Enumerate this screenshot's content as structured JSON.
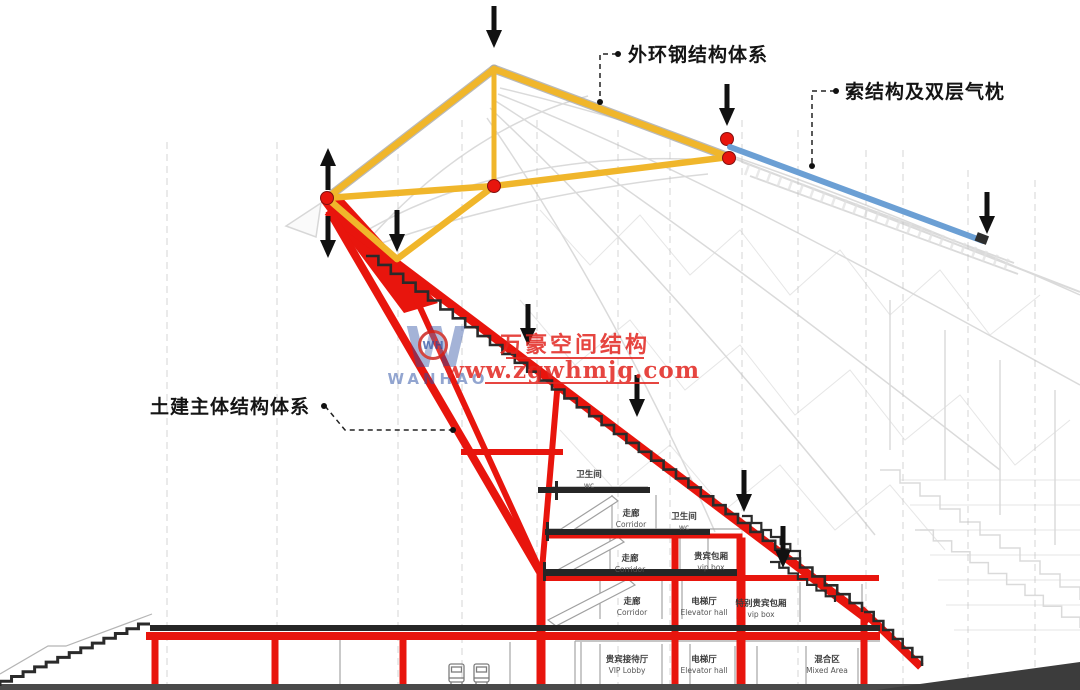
{
  "title": "stadium-structure-section-diagram",
  "annotations": {
    "outer_ring_label": "外环钢结构体系",
    "cable_label": "索结构及双层气枕",
    "civil_label": "土建主体结构体系"
  },
  "watermark": {
    "line1": "万豪空间结构",
    "line2": "www.zgwhmjg.com",
    "logo_letter": "W",
    "logo_monogram": "WH",
    "logo_name": "WANHAO"
  },
  "rooms": [
    {
      "zh": "卫生间",
      "en": "wc",
      "x": 589,
      "y": 477
    },
    {
      "zh": "走廊",
      "en": "Corridor",
      "x": 631,
      "y": 516
    },
    {
      "zh": "卫生间",
      "en": "wc",
      "x": 684,
      "y": 519
    },
    {
      "zh": "走廊",
      "en": "Corridor",
      "x": 630,
      "y": 561
    },
    {
      "zh": "贵宾包厢",
      "en": "vip box",
      "x": 711,
      "y": 559
    },
    {
      "zh": "走廊",
      "en": "Corridor",
      "x": 632,
      "y": 604
    },
    {
      "zh": "电梯厅",
      "en": "Elevator hall",
      "x": 704,
      "y": 604
    },
    {
      "zh": "特别贵宾包厢",
      "en": "vip box",
      "x": 761,
      "y": 606
    },
    {
      "zh": "贵宾接待厅",
      "en": "VIP Lobby",
      "x": 627,
      "y": 662
    },
    {
      "zh": "电梯厅",
      "en": "Elevator hall",
      "x": 704,
      "y": 662
    },
    {
      "zh": "混合区",
      "en": "Mixed Area",
      "x": 827,
      "y": 662
    }
  ],
  "icons": [
    "down-arrow-icon",
    "up-arrow-icon",
    "node-dot-icon",
    "truck-icon",
    "logo-w-icon"
  ],
  "colors": {
    "structure_red": "#e8150d",
    "truss_yellow": "#f0b62b",
    "cable_blue": "#6b9fd4",
    "arrow_black": "#111111",
    "background_gray": "#bdbdbd",
    "watermark_red": "#e2251f",
    "watermark_blue": "#2a4fa2"
  }
}
